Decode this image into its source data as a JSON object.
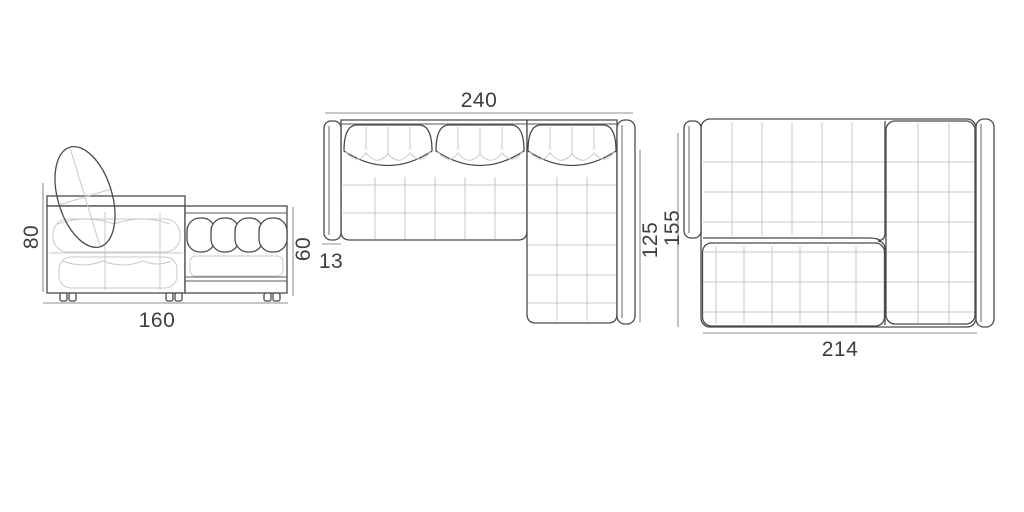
{
  "diagram": {
    "type": "furniture-dimension-drawing",
    "subject": "corner-sofa-with-sleeping-function",
    "background": "#ffffff",
    "colors": {
      "outline": "#4a4a4a",
      "detail_line": "#c9c9c9",
      "dimension_line": "#8f8f8f",
      "label_text": "#3e3e3e"
    },
    "views": [
      {
        "id": "side-view",
        "dimensions": [
          {
            "name": "overall-height",
            "value": "80",
            "orientation": "vertical"
          },
          {
            "name": "overall-depth",
            "value": "160",
            "orientation": "horizontal"
          },
          {
            "name": "chaise-side-height",
            "value": "60",
            "orientation": "vertical"
          }
        ]
      },
      {
        "id": "top-view-sofa",
        "dimensions": [
          {
            "name": "overall-width",
            "value": "240",
            "orientation": "horizontal"
          },
          {
            "name": "chaise-depth",
            "value": "125",
            "orientation": "vertical"
          },
          {
            "name": "armrest-width",
            "value": "13",
            "orientation": "horizontal"
          }
        ]
      },
      {
        "id": "top-view-bed",
        "dimensions": [
          {
            "name": "bed-depth",
            "value": "155",
            "orientation": "vertical"
          },
          {
            "name": "bed-width",
            "value": "214",
            "orientation": "horizontal"
          }
        ]
      }
    ]
  }
}
